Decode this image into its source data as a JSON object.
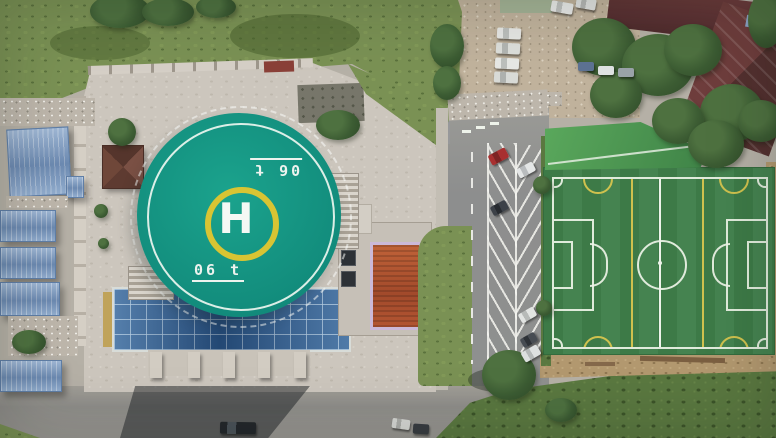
{
  "image": {
    "kind": "aerial-drone-photograph",
    "width_px": 776,
    "height_px": 438,
    "description": "Top-down drone photo: elevated circular rooftop helipad over a blue glass atrium, concrete plaza with brown pavilion and stairs, blue construction sheds on the left, a parking road with angled bays and scattered cars in the middle, an artificial-turf football pitch on the right, maroon roofs and trees at top right, grass fields and scrub around the edges."
  },
  "helipad": {
    "letter": "H",
    "weight_marking": "06 t",
    "marking_note": "painted twice: lower-left upright underlined, upper-right rotated 180 degrees",
    "colors": {
      "deck": "#14957f",
      "outer_ring": "#eff5ef",
      "inner_circle": "#d8c433",
      "letter": "#f5f8f4"
    }
  },
  "football_pitch": {
    "turf": "#3e7b48",
    "white_lines": "#eef3ea",
    "yellow_lines": "#cfc14e",
    "features": [
      "boundary",
      "halfway line",
      "center circle",
      "center spot",
      "penalty areas",
      "goal areas",
      "penalty arcs",
      "corner arcs",
      "two yellow mini-pitch lines",
      "yellow mini-pitch arcs"
    ]
  },
  "palette": {
    "plaza_concrete": "#ccc6bd",
    "asphalt_road": "#8f908f",
    "gravel_lot": "#c0b29c",
    "glass_atrium_blue": "#2d5d92",
    "shed_roof_blue": "#7f9fc6",
    "pavilion_roof_brown": "#64402f",
    "annex_roof_orange": "#b2552f",
    "annex_trim_lavender": "#cbb9d8",
    "maroon_roof": "#63383a",
    "grass": "#7a9154",
    "scrub": "#5a7840",
    "dirt": "#b2986f",
    "tree_canopy": "#3c5c33",
    "shadow": "rgba(28,32,36,0.5)"
  },
  "vehicles": {
    "visible_count": 18,
    "notable": [
      "red car in angled bay",
      "column of four white cars on gravel lot",
      "dark car in building shadow on lower road",
      "white van beside tree"
    ]
  }
}
